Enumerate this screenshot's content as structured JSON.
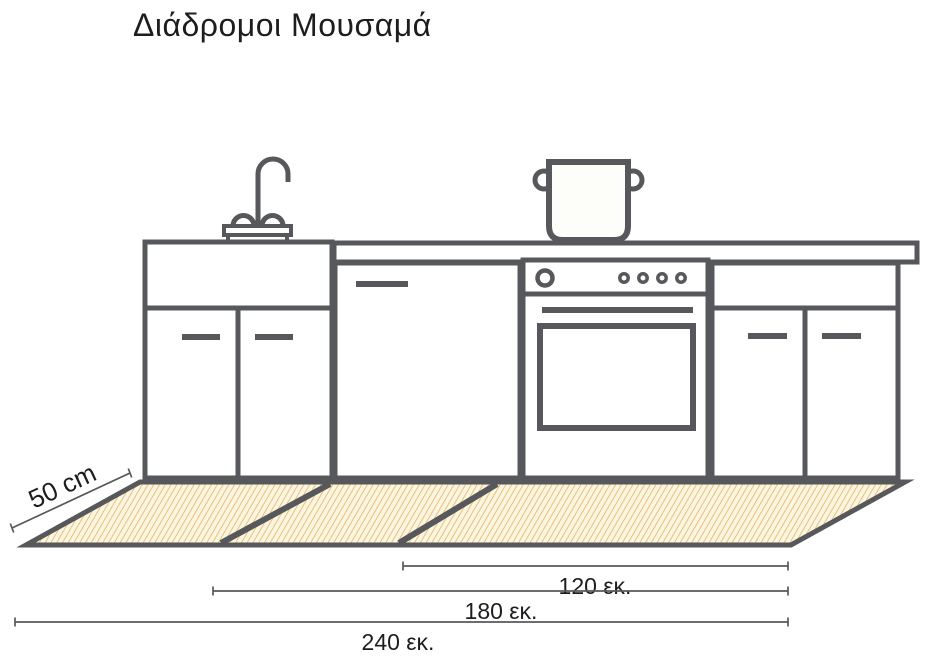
{
  "title": "Διάδρομοι Μουσαμά",
  "mat": {
    "depth_label": "50 cm"
  },
  "dimension_lines": [
    {
      "label": "120 εκ."
    },
    {
      "label": "180 εκ."
    },
    {
      "label": "240 εκ."
    }
  ],
  "colors": {
    "line": "#57585b",
    "hatch_line": "#e3b369",
    "mat_fill": "#fcf5df",
    "label_text": "#1d1d1f"
  }
}
